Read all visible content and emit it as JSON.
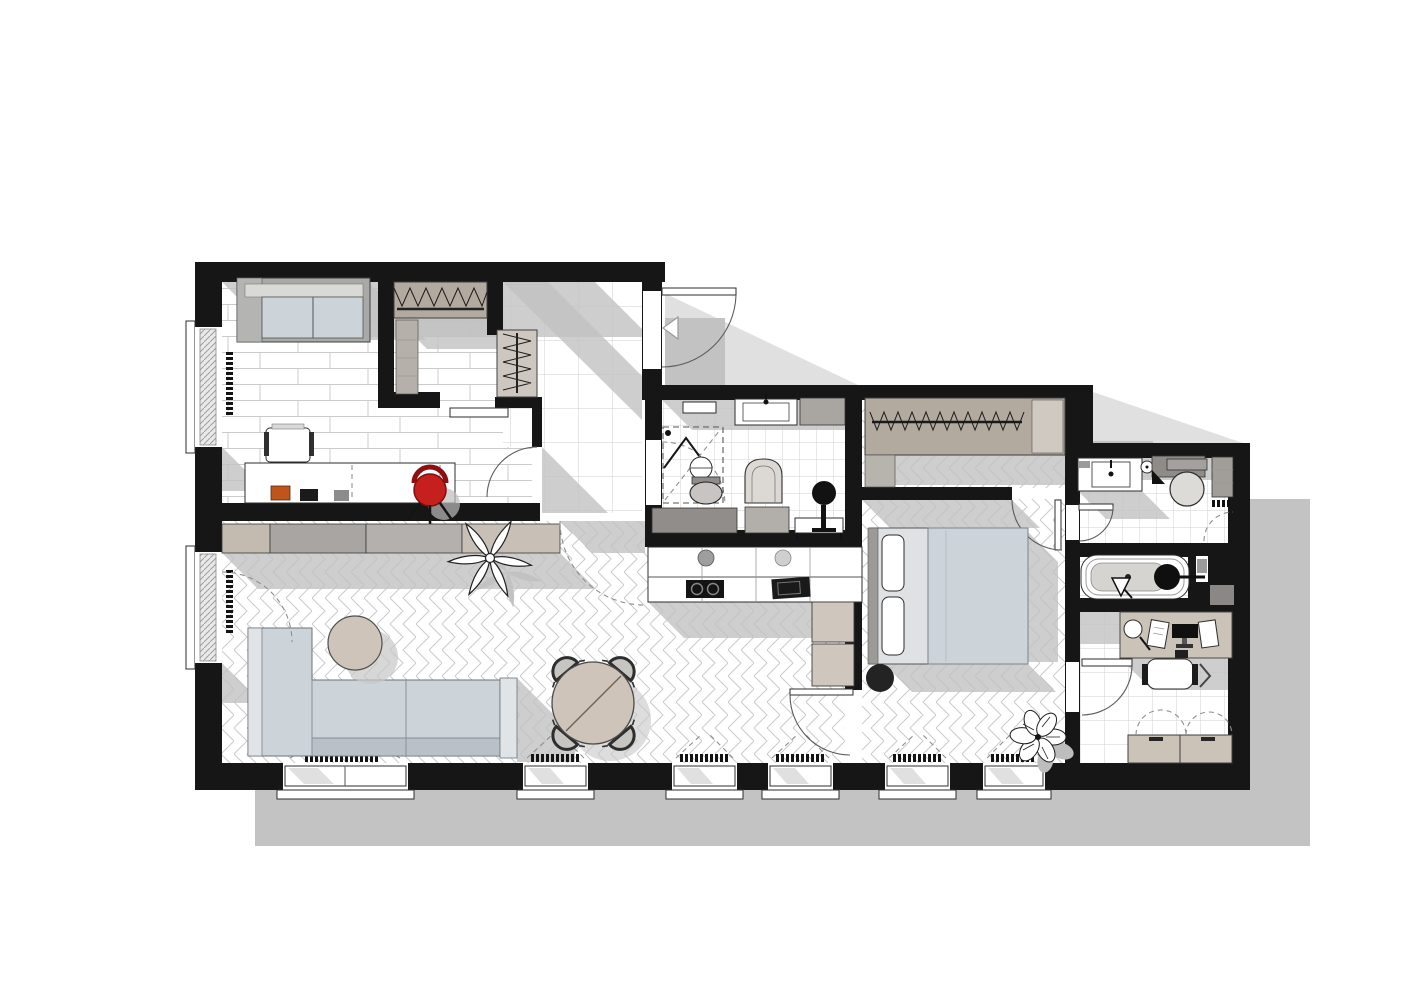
{
  "title": "apartment-floor-plan-render",
  "colors": {
    "wall": "#161616",
    "black": "#141414",
    "white": "#ffffff",
    "floor_line": "#cbcbcb",
    "shadow_outer": "#c3c3c3",
    "shadow_inner": "#c2c2c2",
    "sofa": "#ccd3d9",
    "sofa_light": "#e0e4e7",
    "sofa_back": "#b9c1c8",
    "blanket": "#ccd3d9",
    "tan": "#cfc4ba",
    "beige": "#cbc2b8",
    "grey_cab": "#a9a6a3",
    "wardrobe": "#b2a99f",
    "fixture_grey": "#8f8c88",
    "red": "#c6201e",
    "orange": "#bf541c"
  },
  "rooms": [
    {
      "name": "studio-room",
      "floor": "planks"
    },
    {
      "name": "walk-in-closet",
      "floor": "planks"
    },
    {
      "name": "entry-hall",
      "floor": "large-tiles"
    },
    {
      "name": "wc-shower-room",
      "floor": "small-tiles"
    },
    {
      "name": "kitchen-living-room",
      "floor": "herringbone"
    },
    {
      "name": "bedroom",
      "floor": "herringbone"
    },
    {
      "name": "bathroom",
      "floor": "small-tiles"
    },
    {
      "name": "bathtub-niche",
      "floor": "small-tiles"
    },
    {
      "name": "home-office",
      "floor": "tiles"
    }
  ],
  "inventory": [
    "daybed-sofa",
    "desk-with-laptop",
    "white-desk-chair",
    "red-swivel-chair",
    "closet-hanger-rail",
    "closet-shelves",
    "hall-bench",
    "entry-door",
    "shower-cabin",
    "round-washbasin",
    "toilet",
    "laundry-chair",
    "vanity-cabinet",
    "console-table",
    "round-mirror-stand",
    "tv-sideboard",
    "kitchen-counter",
    "cooktop",
    "kitchen-sink",
    "fridge-cabinets",
    "corner-sofa",
    "round-coffee-table",
    "round-dining-table",
    "four-dining-chairs",
    "lily-plant",
    "double-bed",
    "bedside-pouf",
    "wardrobe-hanger-rail",
    "monstera-plant",
    "bathroom-vanity",
    "toilet-2",
    "bathtub",
    "office-desk",
    "office-chair",
    "office-cabinets"
  ],
  "windows": {
    "bottom": 6,
    "left": 2
  },
  "doors": 8
}
